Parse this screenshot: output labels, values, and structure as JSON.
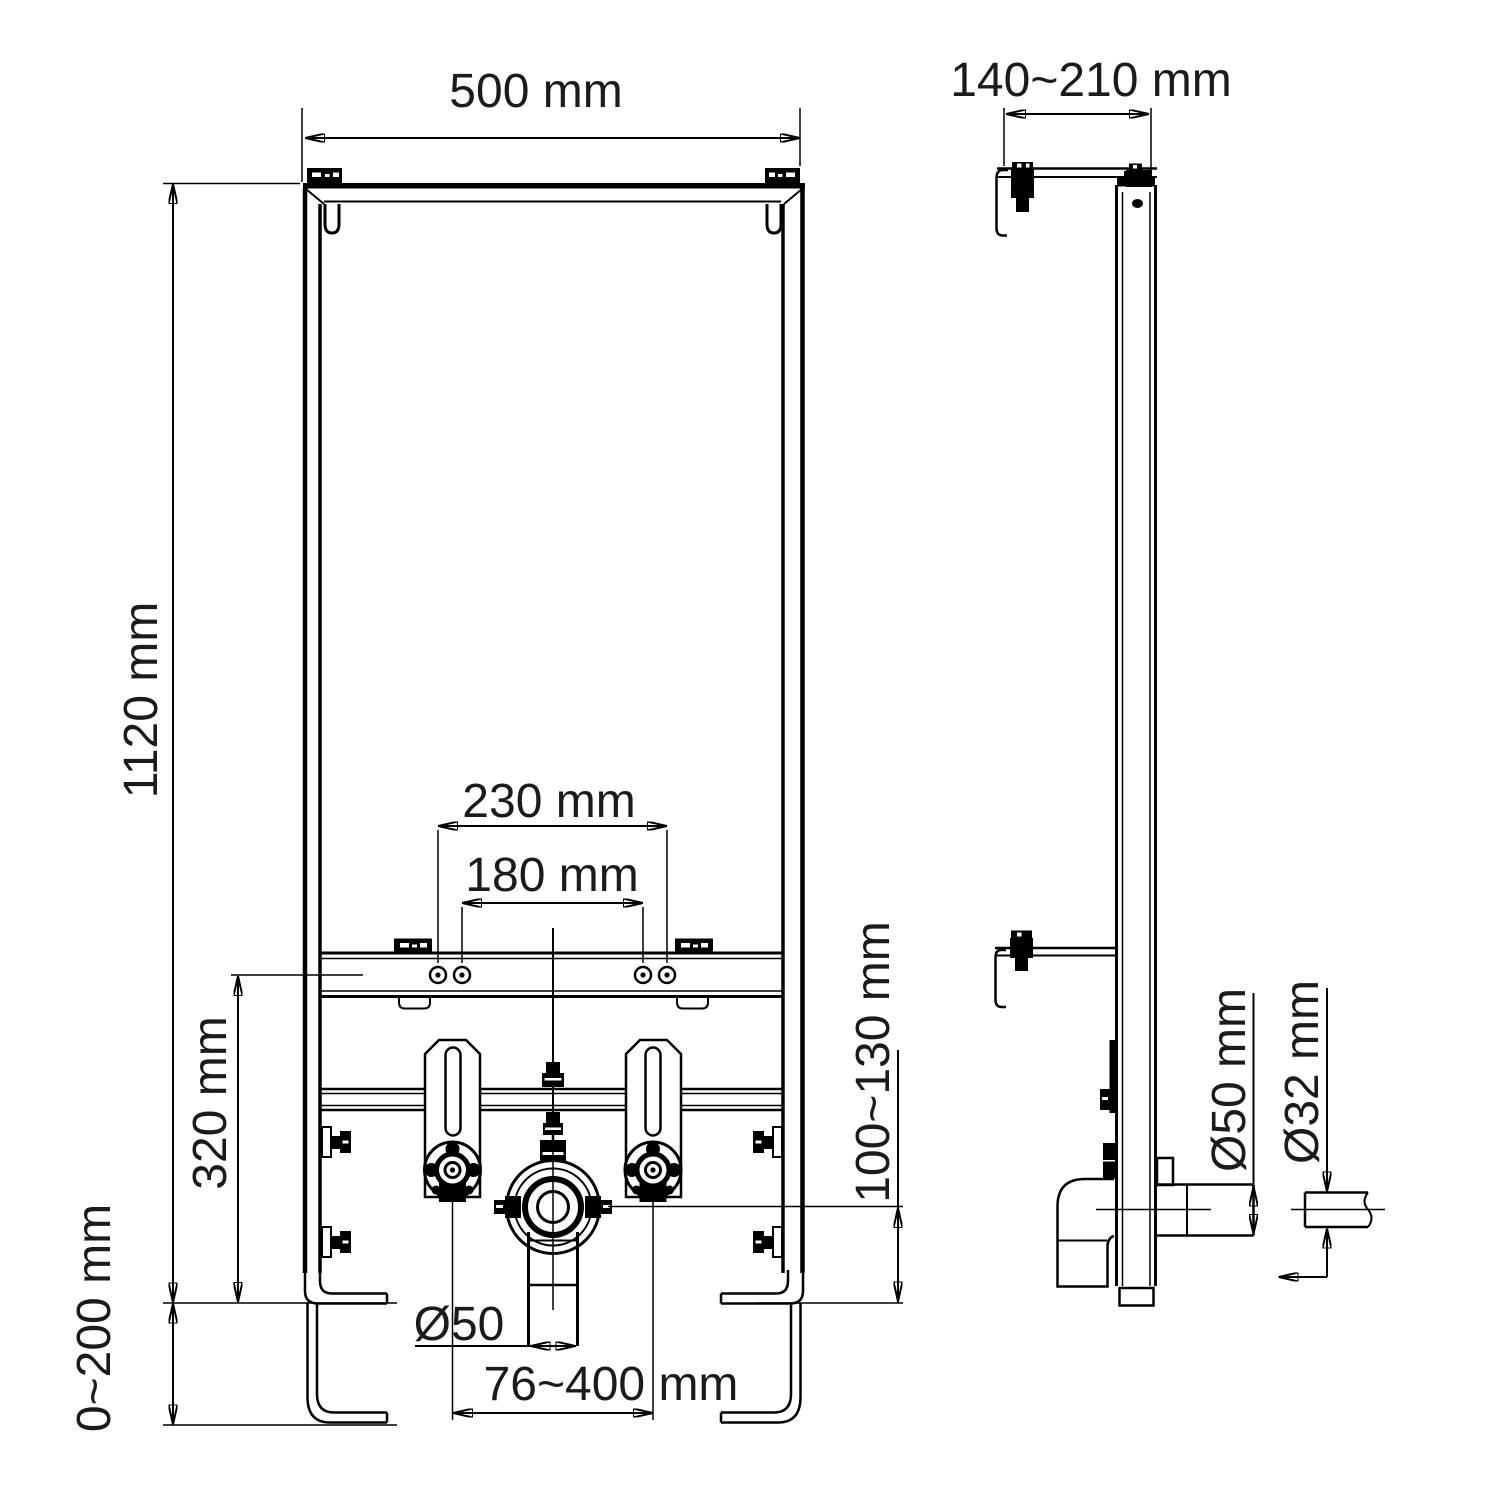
{
  "drawing": {
    "type": "installation-frame technical drawing",
    "views": [
      "front",
      "side"
    ],
    "units": "mm"
  },
  "labels": {
    "front_width": "500 mm",
    "front_height": "1120 mm",
    "stud_height": "320 mm",
    "leg_adjustment": "0~200 mm",
    "outer_hole_spacing": "230 mm",
    "inner_hole_spacing": "180 mm",
    "drain_pipe_diameter": "Ø50",
    "stud_spacing_range": "76~400 mm",
    "drain_outlet_height": "100~130 mm",
    "side_depth": "140~210 mm",
    "drain_socket_diameter": "Ø50 mm",
    "waste_pipe_diameter": "Ø32 mm"
  },
  "colors": {
    "line": "#000000",
    "dimension_text": "#1b1b1b",
    "background": "#ffffff"
  }
}
